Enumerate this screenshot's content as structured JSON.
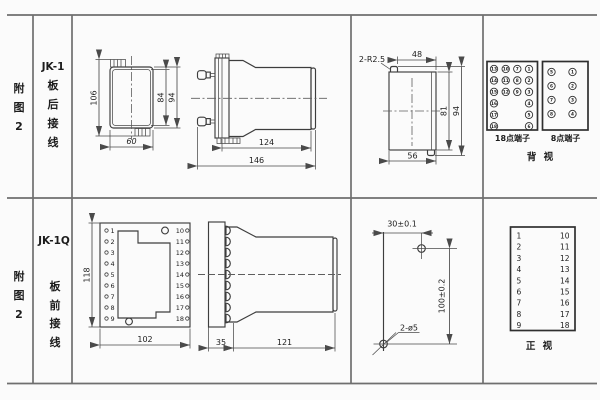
{
  "sheet": {
    "rows": [
      {
        "fig": [
          "附",
          "图",
          "2"
        ],
        "model": "JK-1",
        "wiring": [
          "板",
          "后",
          "接",
          "线"
        ]
      },
      {
        "fig": [
          "附",
          "图",
          "2"
        ],
        "model": "JK-1Q",
        "wiring": [
          "板",
          "前",
          "接",
          "线"
        ]
      }
    ]
  },
  "dims": {
    "jk1_front": {
      "h106": "106",
      "h84": "84",
      "h94": "94",
      "w60": "60"
    },
    "jk1_side": {
      "d124": "124",
      "d146": "146"
    },
    "cutout": {
      "r": "2-R2.5",
      "w48": "48",
      "h81": "81",
      "h94": "94",
      "w56": "56"
    },
    "jk1q_front": {
      "h118": "118",
      "w102": "102"
    },
    "jk1q_side": {
      "d35": "35",
      "d121": "121"
    },
    "drill": {
      "w": "30±0.1",
      "h": "100±0.2",
      "holes": "2-ø5"
    }
  },
  "terminals": {
    "rear18": {
      "caption": "18点端子",
      "cols": [
        [
          "13",
          "14",
          "15",
          "16",
          "17",
          "18"
        ],
        [
          "10",
          "11",
          "12"
        ],
        [
          "7",
          "8",
          "9"
        ],
        [
          "1",
          "2",
          "3",
          "4",
          "5",
          "6"
        ]
      ]
    },
    "rear8": {
      "caption": "8点端子",
      "cols": [
        [
          "5",
          "6",
          "7",
          "8"
        ],
        [
          "1",
          "2",
          "3",
          "4"
        ]
      ]
    },
    "rear_view_label": "背  视",
    "front18": {
      "left": [
        "1",
        "2",
        "3",
        "4",
        "5",
        "6",
        "7",
        "8",
        "9"
      ],
      "right": [
        "10",
        "11",
        "12",
        "13",
        "14",
        "15",
        "16",
        "17",
        "18"
      ]
    },
    "front_view_label": "正  视",
    "plate": {
      "left": [
        "1",
        "2",
        "3",
        "4",
        "5",
        "6",
        "7",
        "8",
        "9"
      ],
      "right": [
        "10",
        "11",
        "12",
        "13",
        "14",
        "15",
        "16",
        "17",
        "18"
      ]
    }
  },
  "colors": {
    "line": "#3d3d3d",
    "grid": "#6f6f6f",
    "background": "#fbfbfb",
    "text": "#1c1c1c"
  }
}
